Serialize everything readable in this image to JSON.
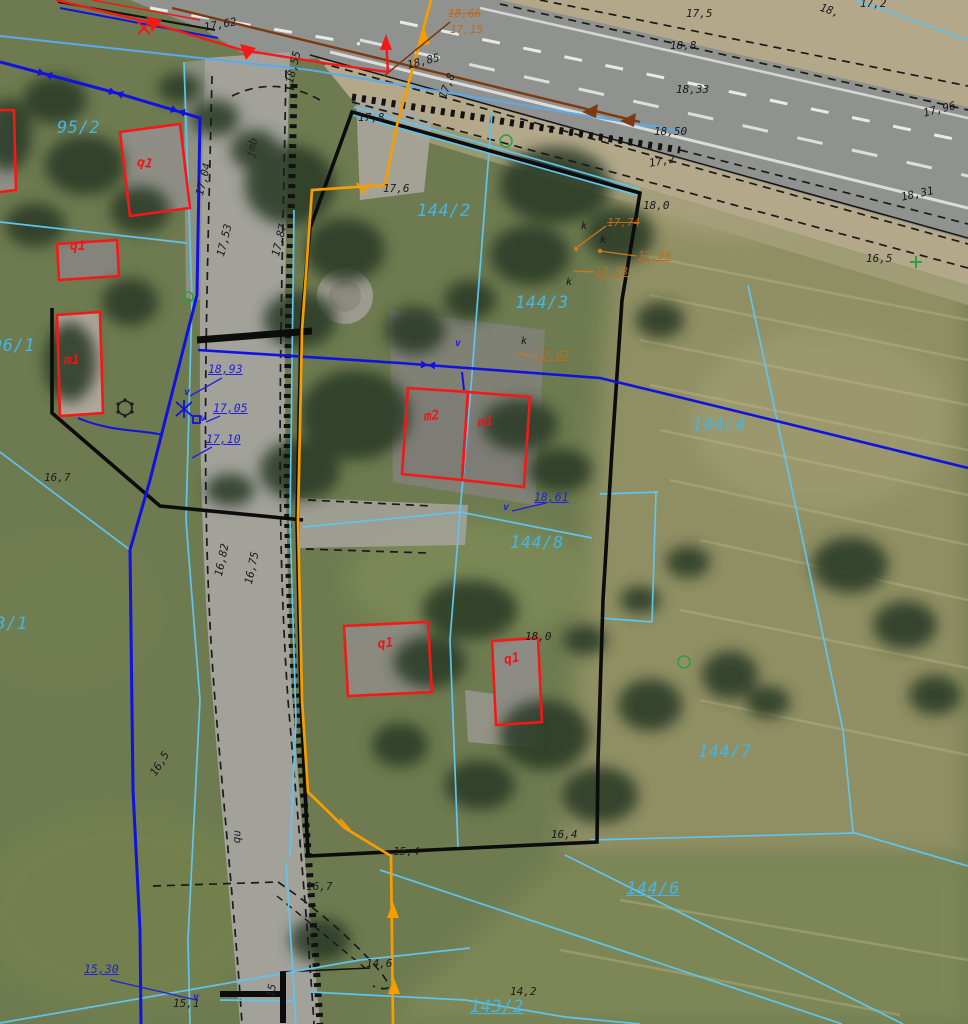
{
  "map": {
    "colors": {
      "parcel": "#45b5e5",
      "bld": "#ef1515",
      "wat": "#2121dd",
      "gas-t": "#c2691a",
      "gas-line": "#f89d00",
      "cad-cyan": "#5fc4ee",
      "water-line": "#1212e0",
      "building-line": "#f51818",
      "drain-brown": "#7c3a10"
    },
    "labels": {
      "parcel": [
        {
          "t": "95/2",
          "x": 57,
          "y": 120
        },
        {
          "t": "96/1",
          "x": -8,
          "y": 338
        },
        {
          "t": "143/1",
          "x": -26,
          "y": 616
        },
        {
          "t": "144/2",
          "x": 417,
          "y": 203
        },
        {
          "t": "144/3",
          "x": 515,
          "y": 295
        },
        {
          "t": "144/4",
          "x": 692,
          "y": 417
        },
        {
          "t": "144/8",
          "x": 510,
          "y": 535
        },
        {
          "t": "144/7",
          "x": 698,
          "y": 744
        },
        {
          "t": "144/6",
          "x": 626,
          "y": 881,
          "u": 1
        },
        {
          "t": "143/2",
          "x": 470,
          "y": 999,
          "u": 1
        }
      ],
      "building": [
        {
          "t": "q1",
          "x": 138,
          "y": 156,
          "r": 8
        },
        {
          "t": "q1",
          "x": 70,
          "y": 240
        },
        {
          "t": "m1",
          "x": 64,
          "y": 354
        },
        {
          "t": "m2",
          "x": 423,
          "y": 411,
          "r": -8
        },
        {
          "t": "m1",
          "x": 477,
          "y": 417,
          "r": -8
        },
        {
          "t": "q1",
          "x": 377,
          "y": 638,
          "r": -6
        },
        {
          "t": "q1",
          "x": 503,
          "y": 654,
          "r": -10
        }
      ],
      "black": [
        {
          "t": "18,85",
          "x": 406,
          "y": 60,
          "r": -14
        },
        {
          "t": "17,8",
          "x": 437,
          "y": 96,
          "r": -68
        },
        {
          "t": "17,62",
          "x": 203,
          "y": 22,
          "r": -10
        },
        {
          "t": "17,5",
          "x": 686,
          "y": 8
        },
        {
          "t": "18,8",
          "x": 670,
          "y": 40
        },
        {
          "t": "18,33",
          "x": 676,
          "y": 84
        },
        {
          "t": "18,50",
          "x": 654,
          "y": 126
        },
        {
          "t": "17,96",
          "x": 922,
          "y": 108,
          "r": -14
        },
        {
          "t": "17,2",
          "x": 648,
          "y": 158,
          "r": -10
        },
        {
          "t": "18,0",
          "x": 643,
          "y": 200
        },
        {
          "t": "18,31",
          "x": 900,
          "y": 192,
          "r": -12
        },
        {
          "t": "16,5",
          "x": 866,
          "y": 253
        },
        {
          "t": "17,8",
          "x": 358,
          "y": 112
        },
        {
          "t": "17,6",
          "x": 383,
          "y": 183
        },
        {
          "t": "18,0",
          "x": 525,
          "y": 631
        },
        {
          "t": "16,7",
          "x": 44,
          "y": 472
        },
        {
          "t": "16,7",
          "x": 306,
          "y": 881
        },
        {
          "t": "16,82",
          "x": 213,
          "y": 575,
          "r": -78
        },
        {
          "t": "16,75",
          "x": 243,
          "y": 583,
          "r": -78
        },
        {
          "t": "16,5",
          "x": 148,
          "y": 772,
          "r": -58
        },
        {
          "t": "15,4",
          "x": 393,
          "y": 846
        },
        {
          "t": "16,4",
          "x": 551,
          "y": 829
        },
        {
          "t": "14,6",
          "x": 366,
          "y": 958
        },
        {
          "t": "14,2",
          "x": 510,
          "y": 986
        },
        {
          "t": "15,1",
          "x": 173,
          "y": 998
        },
        {
          "t": "18,55",
          "x": 284,
          "y": 82,
          "r": -76
        },
        {
          "t": "17,53",
          "x": 215,
          "y": 255,
          "r": -76
        },
        {
          "t": "17,87",
          "x": 270,
          "y": 255,
          "r": -76
        },
        {
          "t": "17,04",
          "x": 194,
          "y": 194,
          "r": -76
        },
        {
          "t": "17,2",
          "x": 860,
          "y": -2
        },
        {
          "t": "18,",
          "x": 822,
          "y": 2,
          "r": 18
        }
      ],
      "blue": [
        {
          "t": "18,93",
          "x": 208,
          "y": 364,
          "u": 1
        },
        {
          "t": "17,05",
          "x": 213,
          "y": 403,
          "u": 1
        },
        {
          "t": "17,10",
          "x": 206,
          "y": 434,
          "u": 1
        },
        {
          "t": "18,61",
          "x": 534,
          "y": 492,
          "u": 1
        },
        {
          "t": "15,30",
          "x": 84,
          "y": 964,
          "u": 1
        }
      ],
      "orange": [
        {
          "t": "18,66",
          "x": 448,
          "y": 8,
          "s": 1
        },
        {
          "t": "17,15",
          "x": 450,
          "y": 24
        },
        {
          "t": "17,74",
          "x": 607,
          "y": 217,
          "s": 1
        },
        {
          "t": "17,56",
          "x": 638,
          "y": 250,
          "u": 1
        },
        {
          "t": "17,73",
          "x": 595,
          "y": 266,
          "u": 1
        },
        {
          "t": "17,67",
          "x": 536,
          "y": 350,
          "u": 1
        }
      ],
      "letters_k": [
        {
          "t": "k",
          "x": 581,
          "y": 222
        },
        {
          "t": "k",
          "x": 600,
          "y": 236
        },
        {
          "t": "k",
          "x": 566,
          "y": 278
        },
        {
          "t": "k",
          "x": 521,
          "y": 337
        }
      ],
      "letters_v": [
        {
          "t": "v",
          "x": 184,
          "y": 388
        },
        {
          "t": "v",
          "x": 200,
          "y": 414
        },
        {
          "t": "v",
          "x": 455,
          "y": 339
        },
        {
          "t": "v",
          "x": 503,
          "y": 503
        },
        {
          "t": "v",
          "x": 193,
          "y": 993
        }
      ],
      "road": [
        {
          "t": "jmb",
          "x": 244,
          "y": 156,
          "r": -76
        },
        {
          "t": "qu",
          "x": 231,
          "y": 843,
          "r": -88
        },
        {
          "t": "15",
          "x": 265,
          "y": 996,
          "r": -80
        }
      ]
    }
  }
}
